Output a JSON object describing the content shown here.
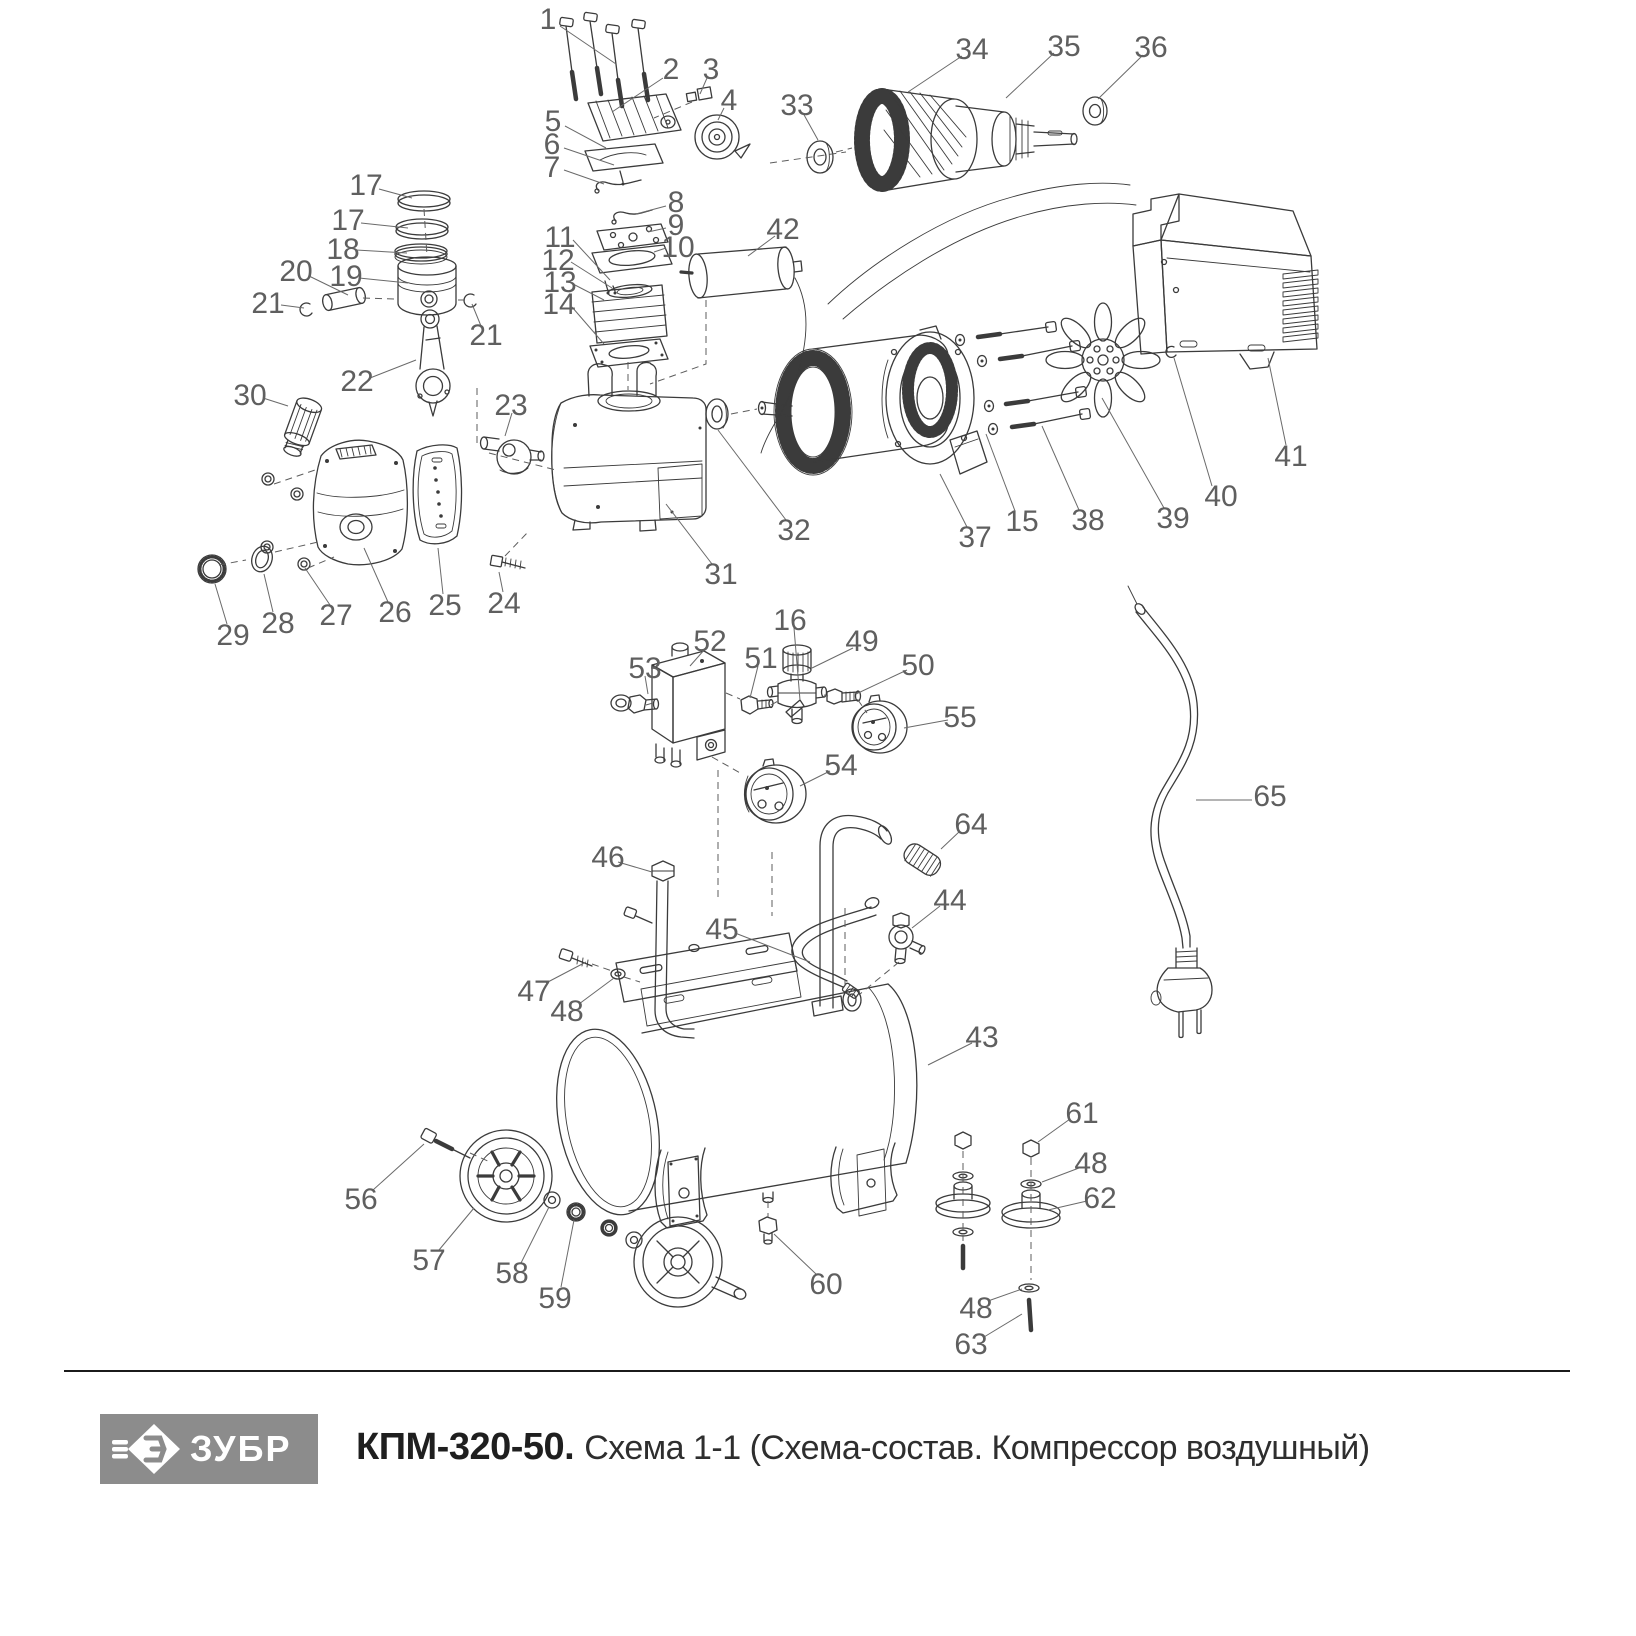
{
  "footer": {
    "logo_text": "ЗУБР",
    "title_model": "КПМ-320-50.",
    "title_rest": "Схема 1-1 (Схема-состав. Компрессор воздушный)",
    "logo_bg": "#8c8c8c",
    "divider_color": "#1b1b1b"
  },
  "diagram": {
    "description": "Exploded parts schematic of air compressor",
    "stroke_color": "#3b3b3b",
    "label_color": "#5f5f5f",
    "leader_color": "#6a6a6a",
    "labels": [
      {
        "t": "1",
        "x": 548,
        "y": 18,
        "l": [
          560,
          26,
          616,
          64
        ]
      },
      {
        "t": "2",
        "x": 671,
        "y": 68,
        "l": [
          663,
          78,
          612,
          112
        ]
      },
      {
        "t": "3",
        "x": 711,
        "y": 68,
        "l": [
          707,
          78,
          700,
          94
        ]
      },
      {
        "t": "4",
        "x": 729,
        "y": 99,
        "l": [
          724,
          108,
          718,
          120
        ]
      },
      {
        "t": "5",
        "x": 553,
        "y": 120,
        "l": [
          565,
          126,
          606,
          148
        ]
      },
      {
        "t": "6",
        "x": 552,
        "y": 143,
        "l": [
          564,
          148,
          614,
          165
        ]
      },
      {
        "t": "7",
        "x": 552,
        "y": 166,
        "l": [
          564,
          170,
          604,
          184
        ]
      },
      {
        "t": "8",
        "x": 676,
        "y": 201,
        "l": [
          666,
          206,
          636,
          214
        ]
      },
      {
        "t": "9",
        "x": 676,
        "y": 224,
        "l": [
          666,
          228,
          648,
          232
        ]
      },
      {
        "t": "10",
        "x": 678,
        "y": 246,
        "l": [
          666,
          248,
          654,
          252
        ]
      },
      {
        "t": "11",
        "x": 560,
        "y": 236,
        "l": [
          573,
          240,
          610,
          280
        ]
      },
      {
        "t": "12",
        "x": 558,
        "y": 259,
        "l": [
          571,
          262,
          612,
          288
        ]
      },
      {
        "t": "13",
        "x": 560,
        "y": 281,
        "l": [
          573,
          284,
          604,
          300
        ]
      },
      {
        "t": "14",
        "x": 559,
        "y": 303,
        "l": [
          572,
          307,
          604,
          344
        ]
      },
      {
        "t": "17",
        "x": 366,
        "y": 184,
        "l": [
          379,
          189,
          412,
          198
        ]
      },
      {
        "t": "17",
        "x": 348,
        "y": 219,
        "l": [
          361,
          223,
          408,
          228
        ]
      },
      {
        "t": "18",
        "x": 343,
        "y": 248,
        "l": [
          356,
          250,
          407,
          253
        ]
      },
      {
        "t": "19",
        "x": 346,
        "y": 275,
        "l": [
          359,
          278,
          408,
          283
        ]
      },
      {
        "t": "20",
        "x": 296,
        "y": 270,
        "l": [
          309,
          276,
          348,
          295
        ]
      },
      {
        "t": "21",
        "x": 268,
        "y": 302,
        "l": [
          281,
          305,
          304,
          308
        ]
      },
      {
        "t": "21",
        "x": 486,
        "y": 334,
        "l": [
          481,
          326,
          472,
          304
        ]
      },
      {
        "t": "22",
        "x": 357,
        "y": 380,
        "l": [
          370,
          378,
          416,
          360
        ]
      },
      {
        "t": "23",
        "x": 511,
        "y": 404,
        "l": [
          512,
          413,
          505,
          436
        ]
      },
      {
        "t": "30",
        "x": 250,
        "y": 394,
        "l": [
          263,
          398,
          288,
          406
        ]
      },
      {
        "t": "24",
        "x": 504,
        "y": 602,
        "l": [
          503,
          592,
          499,
          572
        ]
      },
      {
        "t": "25",
        "x": 445,
        "y": 604,
        "l": [
          443,
          594,
          438,
          548
        ]
      },
      {
        "t": "26",
        "x": 395,
        "y": 611,
        "l": [
          388,
          602,
          364,
          548
        ]
      },
      {
        "t": "27",
        "x": 336,
        "y": 614,
        "l": [
          330,
          605,
          305,
          568
        ]
      },
      {
        "t": "28",
        "x": 278,
        "y": 622,
        "l": [
          273,
          612,
          264,
          574
        ]
      },
      {
        "t": "29",
        "x": 233,
        "y": 634,
        "l": [
          227,
          624,
          215,
          584
        ]
      },
      {
        "t": "33",
        "x": 797,
        "y": 104,
        "l": [
          803,
          113,
          818,
          140
        ]
      },
      {
        "t": "34",
        "x": 972,
        "y": 48,
        "l": [
          962,
          56,
          908,
          92
        ]
      },
      {
        "t": "35",
        "x": 1064,
        "y": 45,
        "l": [
          1054,
          53,
          1006,
          98
        ]
      },
      {
        "t": "36",
        "x": 1151,
        "y": 46,
        "l": [
          1143,
          55,
          1098,
          99
        ]
      },
      {
        "t": "42",
        "x": 783,
        "y": 228,
        "l": [
          775,
          236,
          748,
          256
        ]
      },
      {
        "t": "31",
        "x": 721,
        "y": 573,
        "l": [
          712,
          564,
          666,
          504
        ]
      },
      {
        "t": "32",
        "x": 794,
        "y": 529,
        "l": [
          786,
          520,
          718,
          430
        ]
      },
      {
        "t": "37",
        "x": 975,
        "y": 536,
        "l": [
          967,
          527,
          940,
          474
        ]
      },
      {
        "t": "38",
        "x": 1088,
        "y": 519,
        "l": [
          1079,
          510,
          1042,
          426
        ]
      },
      {
        "t": "39",
        "x": 1173,
        "y": 517,
        "l": [
          1164,
          508,
          1102,
          398
        ]
      },
      {
        "t": "40",
        "x": 1221,
        "y": 495,
        "l": [
          1212,
          486,
          1174,
          358
        ]
      },
      {
        "t": "41",
        "x": 1291,
        "y": 455,
        "l": [
          1286,
          445,
          1268,
          358
        ]
      },
      {
        "t": "15",
        "x": 1022,
        "y": 520,
        "l": [
          1015,
          511,
          986,
          434
        ]
      },
      {
        "t": "16",
        "x": 790,
        "y": 619,
        "l": [
          794,
          628,
          800,
          700
        ]
      },
      {
        "t": "49",
        "x": 862,
        "y": 640,
        "l": [
          853,
          648,
          812,
          668
        ]
      },
      {
        "t": "50",
        "x": 918,
        "y": 664,
        "l": [
          907,
          670,
          856,
          694
        ]
      },
      {
        "t": "51",
        "x": 761,
        "y": 657,
        "l": [
          758,
          666,
          750,
          698
        ]
      },
      {
        "t": "52",
        "x": 710,
        "y": 640,
        "l": [
          705,
          649,
          690,
          666
        ]
      },
      {
        "t": "53",
        "x": 645,
        "y": 667,
        "l": [
          645,
          676,
          648,
          694
        ]
      },
      {
        "t": "54",
        "x": 841,
        "y": 764,
        "l": [
          830,
          771,
          800,
          786
        ]
      },
      {
        "t": "55",
        "x": 960,
        "y": 716,
        "l": [
          948,
          720,
          904,
          728
        ]
      },
      {
        "t": "64",
        "x": 971,
        "y": 823,
        "l": [
          960,
          831,
          941,
          849
        ]
      },
      {
        "t": "65",
        "x": 1270,
        "y": 795,
        "l": [
          1252,
          800,
          1196,
          800
        ]
      },
      {
        "t": "46",
        "x": 608,
        "y": 856,
        "l": [
          618,
          862,
          652,
          872
        ]
      },
      {
        "t": "44",
        "x": 950,
        "y": 899,
        "l": [
          940,
          906,
          912,
          928
        ]
      },
      {
        "t": "45",
        "x": 722,
        "y": 928,
        "l": [
          735,
          933,
          810,
          962
        ]
      },
      {
        "t": "47",
        "x": 534,
        "y": 990,
        "l": [
          546,
          983,
          586,
          962
        ]
      },
      {
        "t": "48",
        "x": 567,
        "y": 1010,
        "l": [
          579,
          1004,
          614,
          978
        ]
      },
      {
        "t": "43",
        "x": 982,
        "y": 1036,
        "l": [
          972,
          1043,
          928,
          1065
        ]
      },
      {
        "t": "56",
        "x": 361,
        "y": 1198,
        "l": [
          373,
          1190,
          424,
          1144
        ]
      },
      {
        "t": "57",
        "x": 429,
        "y": 1259,
        "l": [
          439,
          1250,
          474,
          1208
        ]
      },
      {
        "t": "58",
        "x": 512,
        "y": 1272,
        "l": [
          521,
          1263,
          549,
          1207
        ]
      },
      {
        "t": "59",
        "x": 555,
        "y": 1297,
        "l": [
          561,
          1287,
          574,
          1220
        ]
      },
      {
        "t": "60",
        "x": 826,
        "y": 1283,
        "l": [
          816,
          1274,
          774,
          1234
        ]
      },
      {
        "t": "61",
        "x": 1082,
        "y": 1112,
        "l": [
          1070,
          1119,
          1038,
          1142
        ]
      },
      {
        "t": "48",
        "x": 1091,
        "y": 1162,
        "l": [
          1079,
          1168,
          1042,
          1182
        ]
      },
      {
        "t": "62",
        "x": 1100,
        "y": 1197,
        "l": [
          1087,
          1201,
          1048,
          1210
        ]
      },
      {
        "t": "48",
        "x": 976,
        "y": 1307,
        "l": [
          988,
          1301,
          1022,
          1289
        ]
      },
      {
        "t": "63",
        "x": 971,
        "y": 1343,
        "l": [
          984,
          1337,
          1022,
          1314
        ]
      }
    ]
  }
}
